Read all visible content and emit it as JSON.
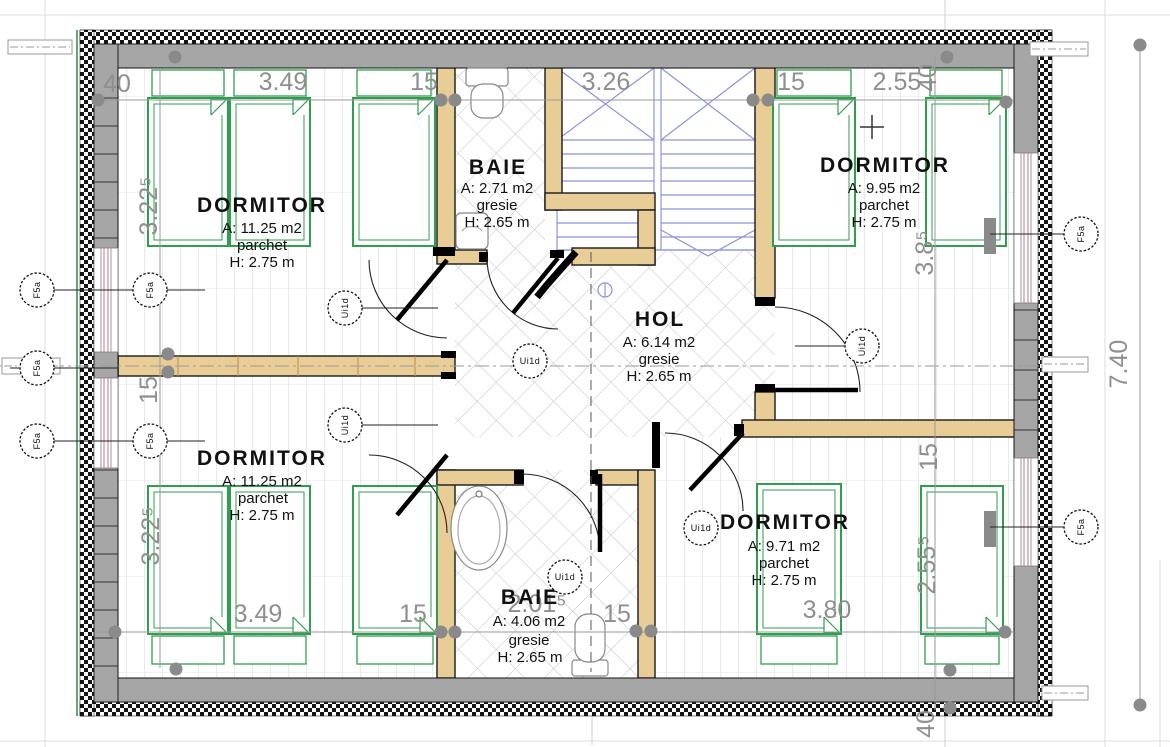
{
  "drawing": {
    "rooms": [
      {
        "name": "DORMITOR",
        "area": "A: 11.25 m2",
        "finish": "parchet",
        "height": "H: 2.75 m"
      },
      {
        "name": "BAIE",
        "area": "A: 2.71 m2",
        "finish": "gresie",
        "height": "H: 2.65 m"
      },
      {
        "name": "DORMITOR",
        "area": "A: 9.95 m2",
        "finish": "parchet",
        "height": "H: 2.75 m"
      },
      {
        "name": "HOL",
        "area": "A: 6.14 m2",
        "finish": "gresie",
        "height": "H: 2.65 m"
      },
      {
        "name": "DORMITOR",
        "area": "A: 11.25 m2",
        "finish": "parchet",
        "height": "H: 2.75 m"
      },
      {
        "name": "BAIE",
        "area": "A: 4.06 m2",
        "finish": "gresie",
        "height": "H: 2.65 m"
      },
      {
        "name": "DORMITOR",
        "area": "A: 9.71 m2",
        "finish": "parchet",
        "height": "H: 2.75 m"
      }
    ],
    "dimensions": {
      "top": [
        "40",
        "3.49",
        "15",
        "3.26",
        "15",
        "2.55",
        "40"
      ],
      "bottom": [
        "3.49",
        "15",
        "2.01⁵",
        "15",
        "3.80",
        "40"
      ],
      "left": [
        "3.22⁵",
        "15",
        "3.22⁵"
      ],
      "right": [
        "3.8⁵",
        "15",
        "2.55⁵",
        "7.40"
      ]
    },
    "markers": {
      "window_tag": "F5a",
      "door_tag": "Ui1d"
    },
    "colors": {
      "wall_gray": "#a6a6a6",
      "insulation": "#111111",
      "wood_wall": "#e9cd96",
      "furniture_green": "#2f9e4f",
      "stair_blue": "#8b93dd",
      "dimension_gray": "#8f8f8f",
      "site_green": "#2e8b46",
      "window_red": "#c2748a"
    }
  }
}
